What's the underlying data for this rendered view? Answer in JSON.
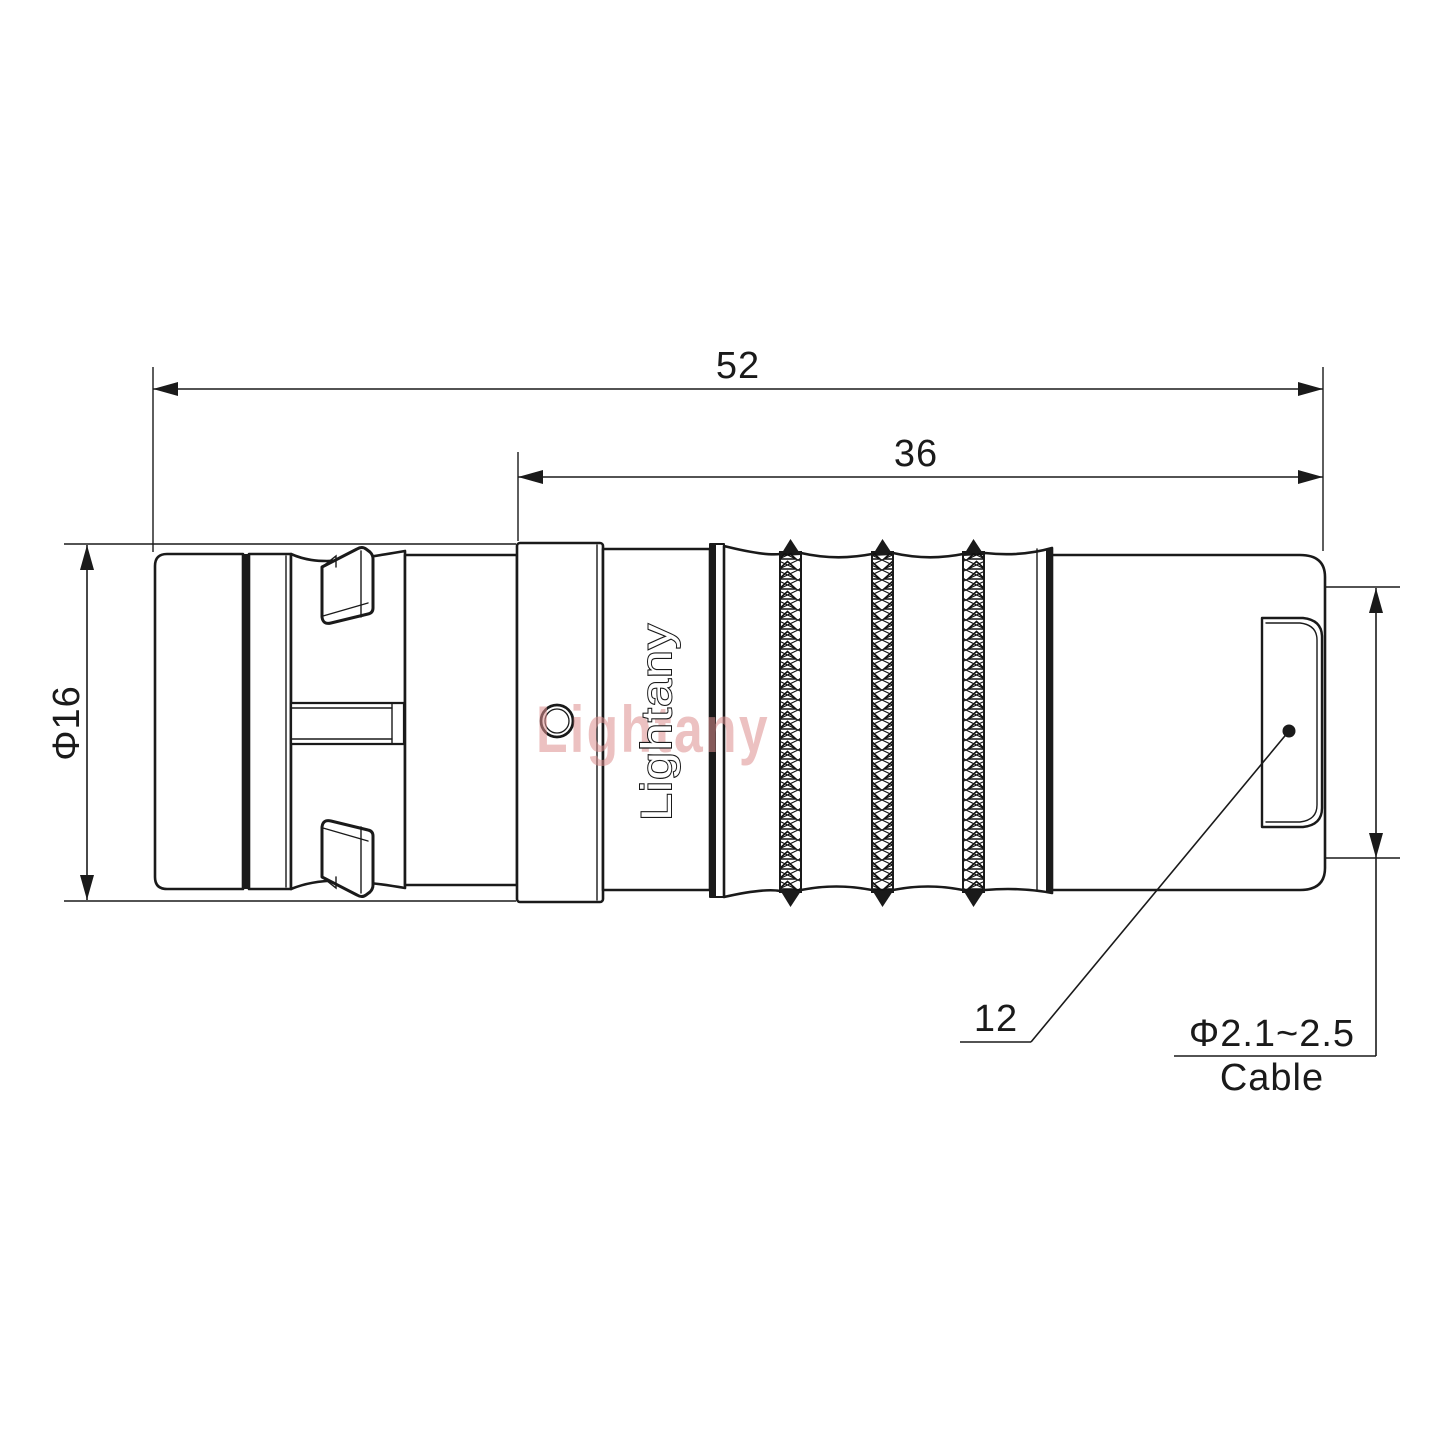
{
  "page": {
    "background": "#ffffff",
    "kind": "engineering drawing, side view of a push-pull circular cable connector plug"
  },
  "drawing": {
    "dimensions": {
      "overall_length": "52",
      "rear_length": "36",
      "shell_diameter": "Φ16",
      "nut_ref": "12",
      "cable_range": "Φ2.1~2.5",
      "cable_label": "Cable"
    },
    "branding": {
      "engraving": "Lightany",
      "watermark": "Lightany"
    },
    "colors": {
      "line": "#1a1a1a",
      "watermark": "#dd9090",
      "background": "#ffffff"
    }
  }
}
